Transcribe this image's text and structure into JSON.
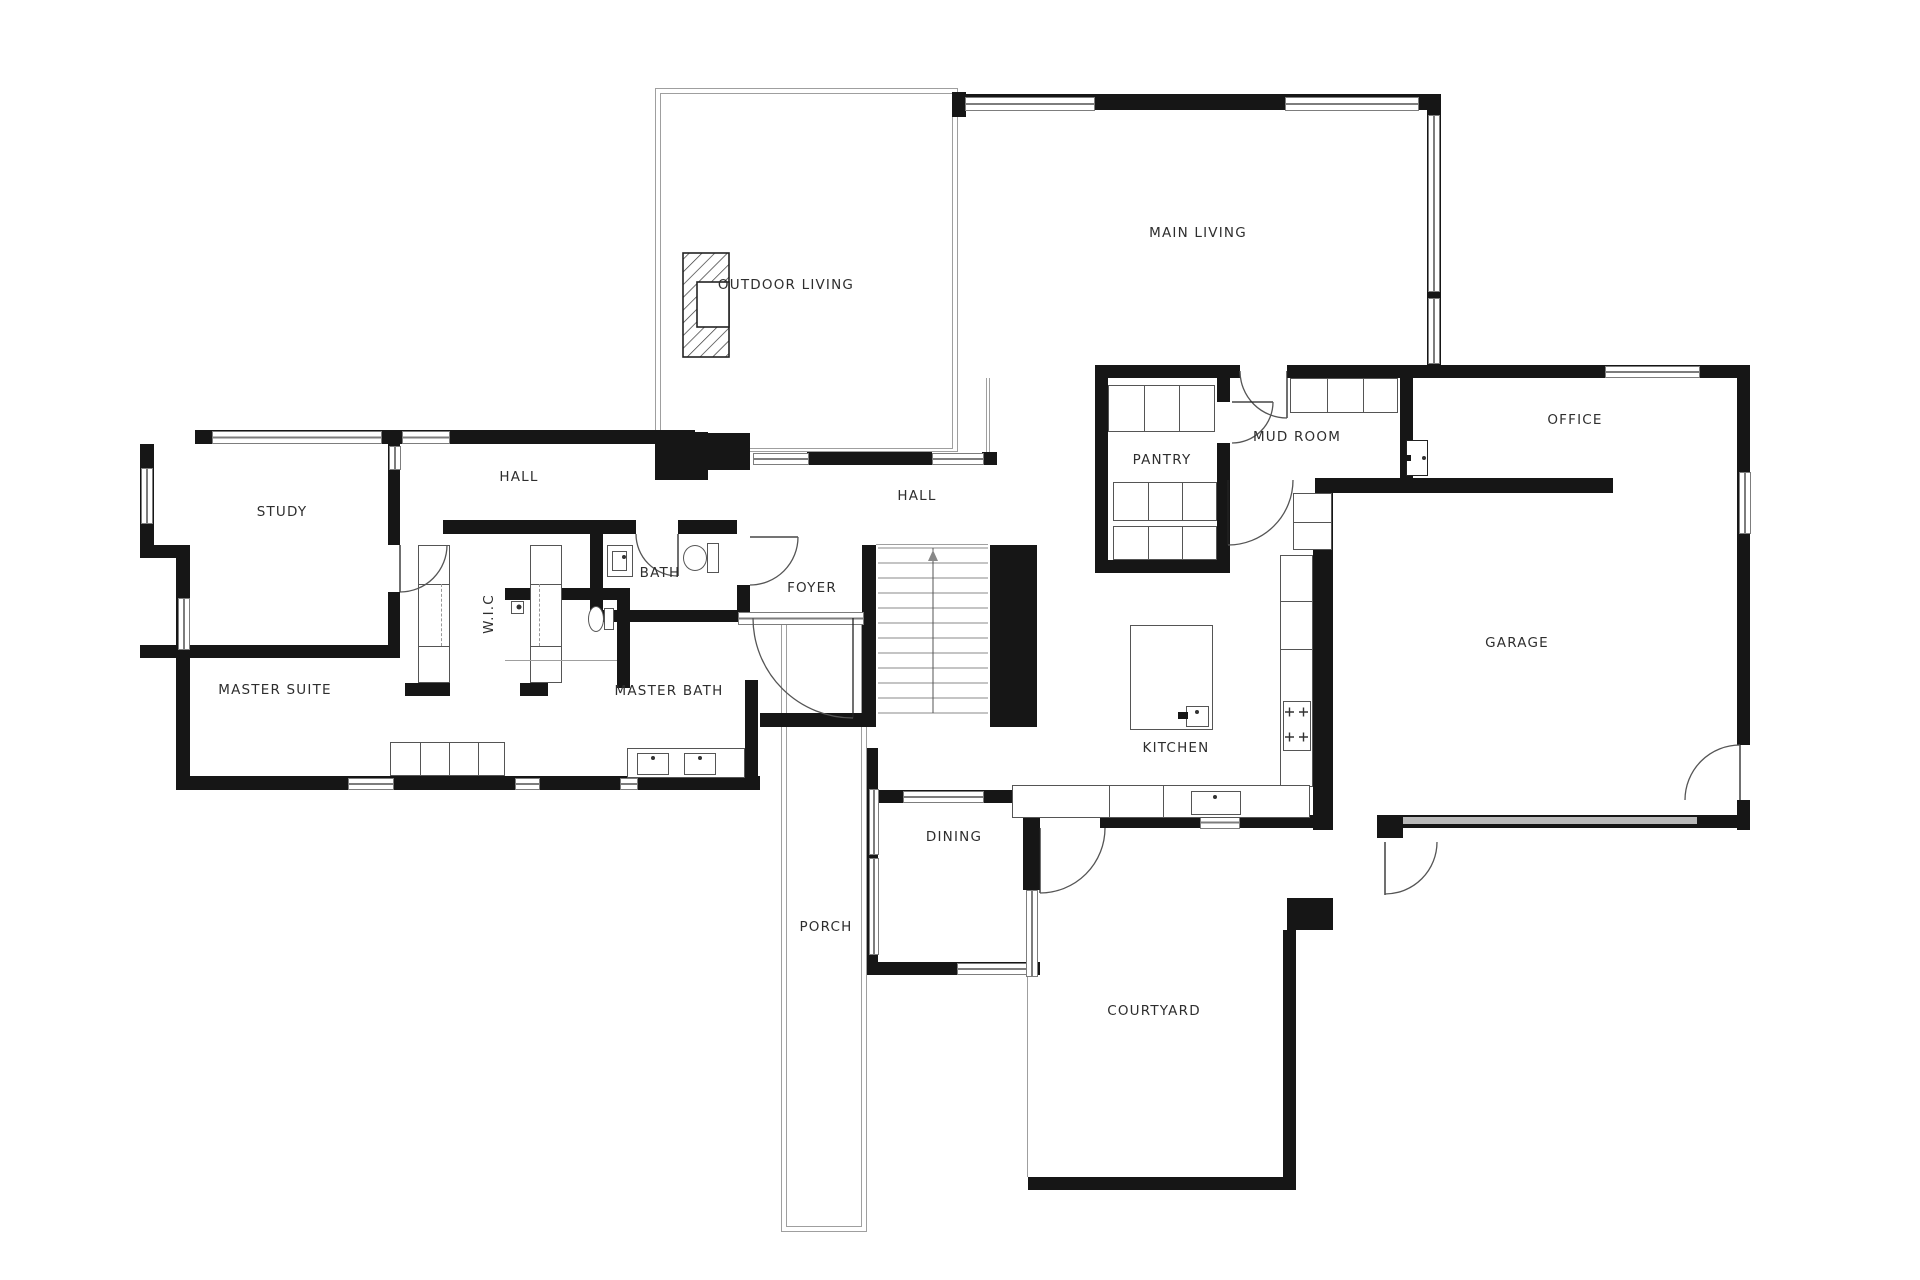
{
  "title": "Floor plan",
  "rooms": [
    {
      "id": "outdoor-living",
      "label": "OUTDOOR LIVING"
    },
    {
      "id": "main-living",
      "label": "MAIN LIVING"
    },
    {
      "id": "hall-west",
      "label": "HALL"
    },
    {
      "id": "study",
      "label": "STUDY"
    },
    {
      "id": "master-suite",
      "label": "MASTER SUITE"
    },
    {
      "id": "wic",
      "label": "W.I.C"
    },
    {
      "id": "bath",
      "label": "BATH"
    },
    {
      "id": "master-bath",
      "label": "MASTER BATH"
    },
    {
      "id": "hall-east",
      "label": "HALL"
    },
    {
      "id": "foyer",
      "label": "FOYER"
    },
    {
      "id": "pantry",
      "label": "PANTRY"
    },
    {
      "id": "mud-room",
      "label": "MUD ROOM"
    },
    {
      "id": "office",
      "label": "OFFICE"
    },
    {
      "id": "garage",
      "label": "GARAGE"
    },
    {
      "id": "kitchen",
      "label": "KITCHEN"
    },
    {
      "id": "dining",
      "label": "DINING"
    },
    {
      "id": "porch",
      "label": "PORCH"
    },
    {
      "id": "courtyard",
      "label": "COURTYARD"
    }
  ],
  "colors": {
    "wall": "#161616",
    "thin_line": "#9f9f9f",
    "window_frame": "#7d7d7d",
    "label": "#2e2e2e",
    "garage_door": "#b9b9b9",
    "background": "#ffffff"
  }
}
